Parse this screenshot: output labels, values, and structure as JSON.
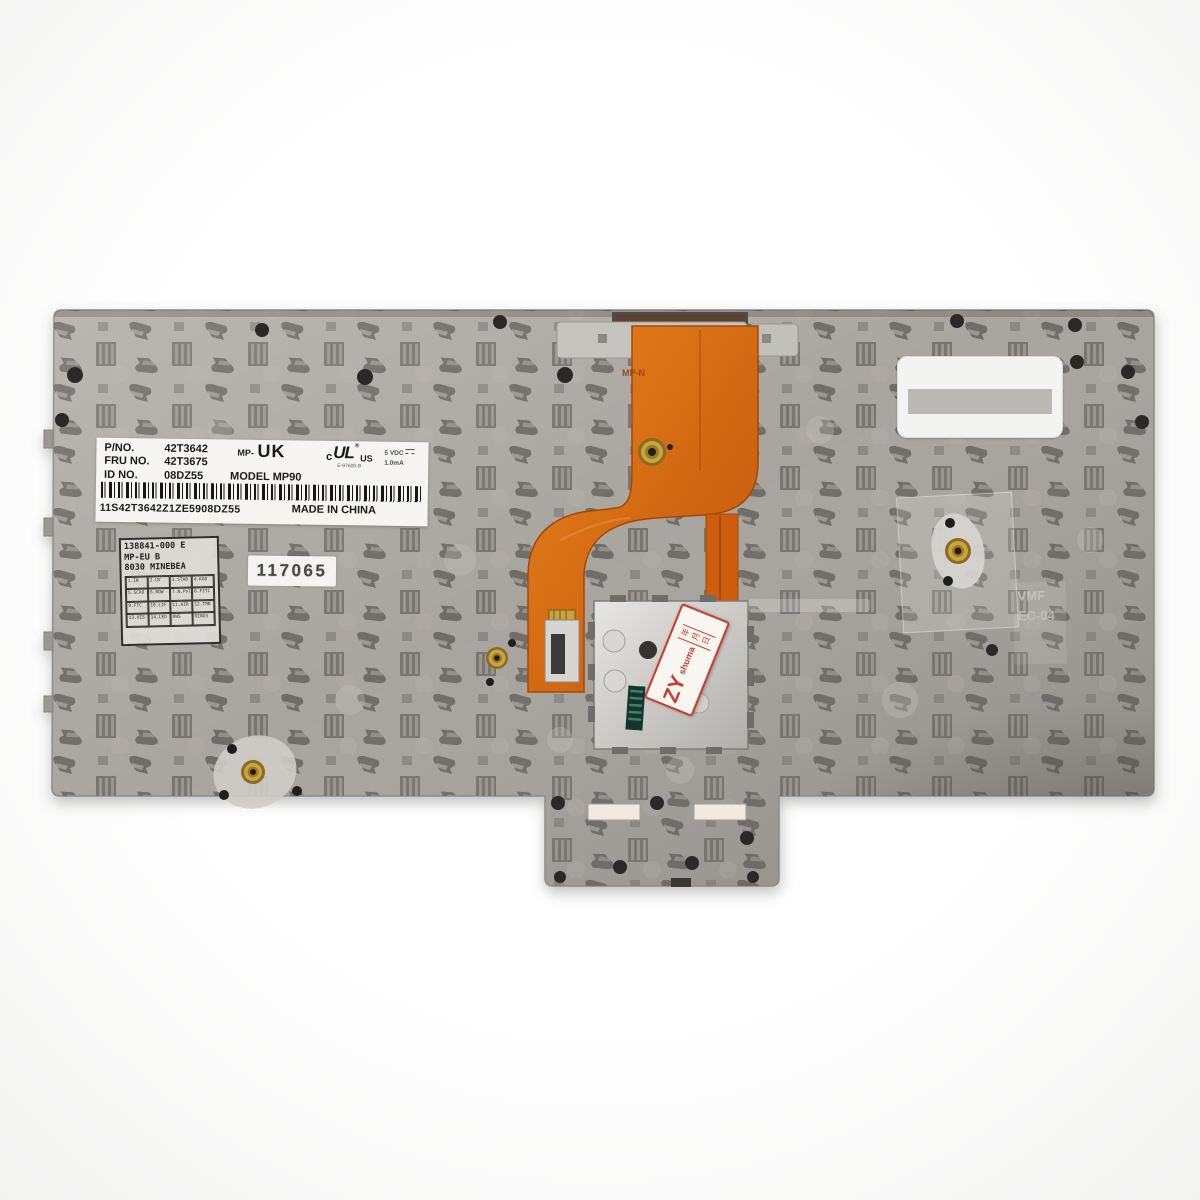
{
  "label_main": {
    "pno_label": "P/NO.",
    "pno_value": "42T3642",
    "mp_prefix": "MP-",
    "region": "UK",
    "fru_label": "FRU NO.",
    "fru_value": "42T3675",
    "id_label": "ID NO.",
    "id_value": "08DZ55",
    "model": "MODEL MP90",
    "ul_c": "c",
    "ul_letters": "UL",
    "ul_reg": "®",
    "ul_us": "US",
    "ul_file": "E-97600-B",
    "rating_v": "5 VDC",
    "rating_a": "1.0mA",
    "serial": "11S42T3642Z1ZE5908DZ55",
    "origin": "MADE IN CHINA"
  },
  "label_spec": {
    "line1": "138841-000 E",
    "line2": "MP-EU B",
    "line3": "8030 MINEBEA",
    "grid": [
      [
        "1.IN",
        "2.UV",
        "3.STAB",
        "4.KGD"
      ],
      [
        "5.SCRO",
        "6.ROW",
        "7.N.Pol",
        "8.FITC"
      ],
      [
        "9.FTC",
        "10.LIF",
        "11.AIR",
        "12.TMB"
      ],
      [
        "13.VIS",
        "14.LED",
        "RWS",
        "RINGS"
      ]
    ]
  },
  "stamp": {
    "number": "117065"
  },
  "qc_sticker": {
    "brand": "ZY",
    "sub": "shuma",
    "date": "年月日"
  },
  "faint_marking": {
    "line1": "VMF",
    "line2": "EC-04"
  },
  "cable_marking": "MP-N",
  "colors": {
    "plate": "#a7a39d",
    "cable_orange": "#d96a12",
    "label_bg": "#f6f5f2",
    "sticker_red": "#d0382c",
    "brass": "#c2a23c",
    "background": "#ffffff"
  }
}
